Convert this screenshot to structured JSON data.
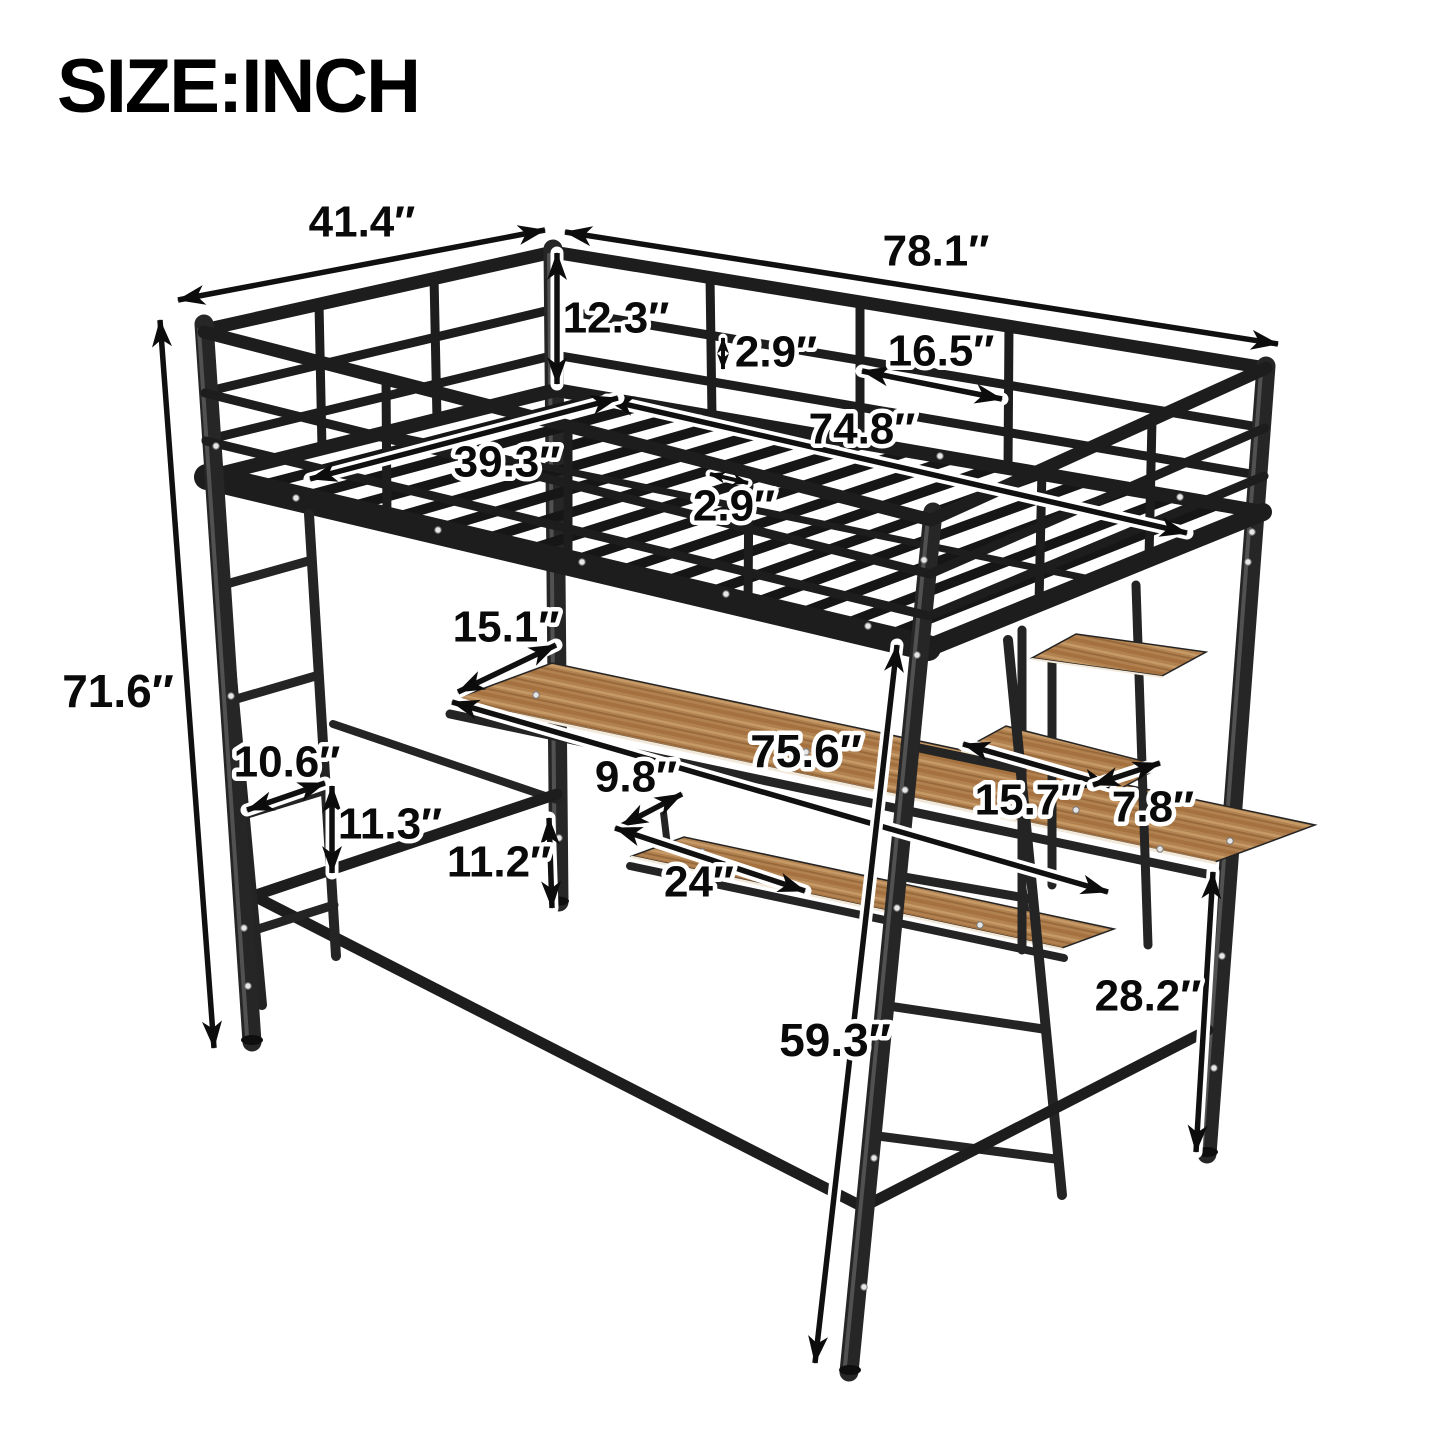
{
  "title": "SIZE:INCH",
  "unit": "inch",
  "colors": {
    "background": "#ffffff",
    "metal_dark": "#1d1d1d",
    "metal_post": "#262626",
    "metal_highlight": "#606060",
    "wood_base": "#b28150",
    "wood_dark": "#a4713f",
    "wood_light": "#c59a66",
    "label_text": "#0a0a0a",
    "label_halo": "#ffffff"
  },
  "dimensions": [
    {
      "id": "top-width",
      "label": "41.4″",
      "line": [
        178,
        300,
        545,
        230
      ],
      "label_pos": [
        362,
        222
      ],
      "fs": 44,
      "head": "n"
    },
    {
      "id": "top-length",
      "label": "78.1″",
      "line": [
        565,
        232,
        1278,
        344
      ],
      "label_pos": [
        936,
        251
      ],
      "fs": 44,
      "head": "n"
    },
    {
      "id": "guardrail-height",
      "label": "12.3″",
      "line": [
        557,
        253,
        557,
        384
      ],
      "label_pos": [
        616,
        318
      ],
      "fs": 44,
      "head": "n"
    },
    {
      "id": "rail-gap",
      "label": "2.9″",
      "line": [
        723,
        338,
        723,
        369
      ],
      "label_pos": [
        776,
        352
      ],
      "fs": 44,
      "head": "s"
    },
    {
      "id": "rail-segment",
      "label": "16.5″",
      "line": [
        862,
        371,
        1002,
        399
      ],
      "label_pos": [
        941,
        351
      ],
      "fs": 44,
      "head": "n"
    },
    {
      "id": "bed-inner-length",
      "label": "74.8″",
      "line": [
        607,
        400,
        1187,
        533
      ],
      "label_pos": [
        862,
        429
      ],
      "fs": 44,
      "head": "n"
    },
    {
      "id": "bed-inner-width",
      "label": "39.3″",
      "line": [
        310,
        479,
        618,
        398
      ],
      "label_pos": [
        507,
        462
      ],
      "fs": 44,
      "head": "n"
    },
    {
      "id": "slat-gap",
      "label": "2.9″",
      "line": [
        710,
        474,
        748,
        483
      ],
      "label_pos": [
        734,
        506
      ],
      "fs": 44,
      "head": "s"
    },
    {
      "id": "overall-height",
      "label": "71.6″",
      "line": [
        160,
        320,
        214,
        1048
      ],
      "label_pos": [
        118,
        691
      ],
      "fs": 46,
      "head": "n"
    },
    {
      "id": "desk-depth",
      "label": "15.1″",
      "line": [
        458,
        692,
        556,
        645
      ],
      "label_pos": [
        506,
        627
      ],
      "fs": 44,
      "head": "n"
    },
    {
      "id": "desk-length",
      "label": "75.6″",
      "line": [
        452,
        702,
        1108,
        892
      ],
      "label_pos": [
        806,
        751
      ],
      "fs": 46,
      "head": "n"
    },
    {
      "id": "ladder-width",
      "label": "10.6″",
      "line": [
        247,
        810,
        325,
        783
      ],
      "label_pos": [
        287,
        762
      ],
      "fs": 44,
      "head": "n"
    },
    {
      "id": "rung-spacing",
      "label": "11.3″",
      "line": [
        332,
        786,
        332,
        873
      ],
      "label_pos": [
        390,
        824
      ],
      "fs": 44,
      "head": "n"
    },
    {
      "id": "tray-height",
      "label": "11.2″",
      "line": [
        549,
        818,
        552,
        908
      ],
      "label_pos": [
        499,
        862
      ],
      "fs": 44,
      "head": "n"
    },
    {
      "id": "tray-depth",
      "label": "9.8″",
      "line": [
        621,
        826,
        682,
        794
      ],
      "label_pos": [
        636,
        777
      ],
      "fs": 44,
      "head": "n"
    },
    {
      "id": "tray-width",
      "label": "24″",
      "line": [
        615,
        828,
        805,
        891
      ],
      "label_pos": [
        699,
        882
      ],
      "fs": 44,
      "head": "n"
    },
    {
      "id": "shelf-width",
      "label": "15.7″",
      "line": [
        963,
        744,
        1110,
        786
      ],
      "label_pos": [
        1028,
        800
      ],
      "fs": 44,
      "head": "n"
    },
    {
      "id": "shelf-depth",
      "label": "7.8″",
      "line": [
        1093,
        785,
        1160,
        763
      ],
      "label_pos": [
        1153,
        807
      ],
      "fs": 44,
      "head": "n"
    },
    {
      "id": "underbed-height",
      "label": "59.3″",
      "line": [
        897,
        645,
        815,
        1363
      ],
      "label_pos": [
        835,
        1040
      ],
      "fs": 46,
      "head": "n"
    },
    {
      "id": "desk-floor-height",
      "label": "28.2″",
      "line": [
        1213,
        872,
        1196,
        1152
      ],
      "label_pos": [
        1148,
        996
      ],
      "fs": 44,
      "head": "n"
    }
  ]
}
